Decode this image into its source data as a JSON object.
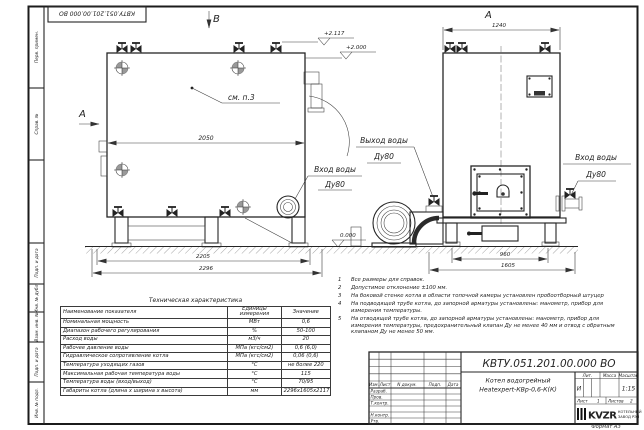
{
  "doc": {
    "number": "КВТУ.051.201.00.000 ВО",
    "format_note": "Формат А3"
  },
  "drawing": {
    "view_b_label": "В",
    "view_a_arrow": "А",
    "view_a_title": "А",
    "see_note": "см. п.3",
    "dim_2050": "2050",
    "dim_2205": "2205",
    "dim_2296": "2296",
    "dim_1240": "1240",
    "dim_960": "960",
    "dim_1605": "1605",
    "elev_top": "+2.117",
    "elev_mid": "+2.000",
    "elev_zero": "0.000",
    "inlet_b_line1": "Вход воды",
    "inlet_b_line2": "Ду80",
    "outlet_line1": "Выход воды",
    "outlet_line2": "Ду80",
    "inlet_a_line1": "Вход воды",
    "inlet_a_line2": "Ду80"
  },
  "margin": [
    "Перв. примен.",
    "Справ. №",
    "Подп. и дата",
    "Инв. № дубл.",
    "Взам. инв. №",
    "Подп. и дата",
    "Инв. № подл."
  ],
  "notes": {
    "items": [
      {
        "num": "1",
        "text": "Все размеры для справок."
      },
      {
        "num": "2",
        "text": "Допустимое отклонение ±100 мм."
      },
      {
        "num": "3",
        "text": "На боковой стенке котла в области топочной камеры установлен пробоотборный штуцер"
      },
      {
        "num": "4",
        "text": "На подводящей трубе котла, до запорной арматуры установлены: манометр, прибор для измерения температуры."
      },
      {
        "num": "5",
        "text": "На отводящей трубе котла, до запорной арматуры установлены: манометр, прибор для измерения температуры, предохранительный клапан Ду не менее 40 мм и отвод с обратным клапаном Ду не менее 50 мм."
      }
    ]
  },
  "tech_table": {
    "title": "Техническая характеристика",
    "col_name": "Наименование показателя",
    "col_units": "Единицы измерения",
    "col_value": "Значение",
    "rows": [
      [
        "Номинальная мощность",
        "МВт",
        "0,6"
      ],
      [
        "Диапазон рабочего регулирования",
        "%",
        "50-100"
      ],
      [
        "Расход воды",
        "м3/ч",
        "20"
      ],
      [
        "Рабочее давление воды",
        "МПа (кгс/см2)",
        "0,6 (6,0)"
      ],
      [
        "Гидравлическое сопротивление котла",
        "МПа (кгс/см2)",
        "0,06 (0,6)"
      ],
      [
        "Температура уходящих газов",
        "°С",
        "не более 220"
      ],
      [
        "Максимальная рабочая температура воды",
        "°С",
        "115"
      ],
      [
        "Температура воды (вход/выход)",
        "°С",
        "70/95"
      ],
      [
        "Габариты котла (длина х ширина х высота)",
        "мм",
        "2296х1605х2117"
      ]
    ]
  },
  "stamp": {
    "doc_number": "КВТУ.051.201.00.000  ВО",
    "product_line1": "Котел водогрейный",
    "product_line2": "Heatexpert-КВр-0,6-К(К)",
    "rev_cols": [
      "Изм.",
      "Лист",
      "N докум.",
      "Подп.",
      "Дата"
    ],
    "sign_rows": [
      "Разраб.",
      "Пров.",
      "Т.контр.",
      "",
      "Н.контр.",
      "Утв."
    ],
    "lit_label": "Лит.",
    "mass_label": "Масса",
    "scale_label": "Масштаб",
    "lit_value": "И",
    "scale_value": "1:15",
    "sheet_label": "Лист",
    "sheet_num": "1",
    "sheets_label": "Листов",
    "sheets_num": "2",
    "logo_text": "KVZR",
    "company_line1": "КОТЕЛЬНЫЙ",
    "company_line2": "ЗАВОД РЭП"
  }
}
